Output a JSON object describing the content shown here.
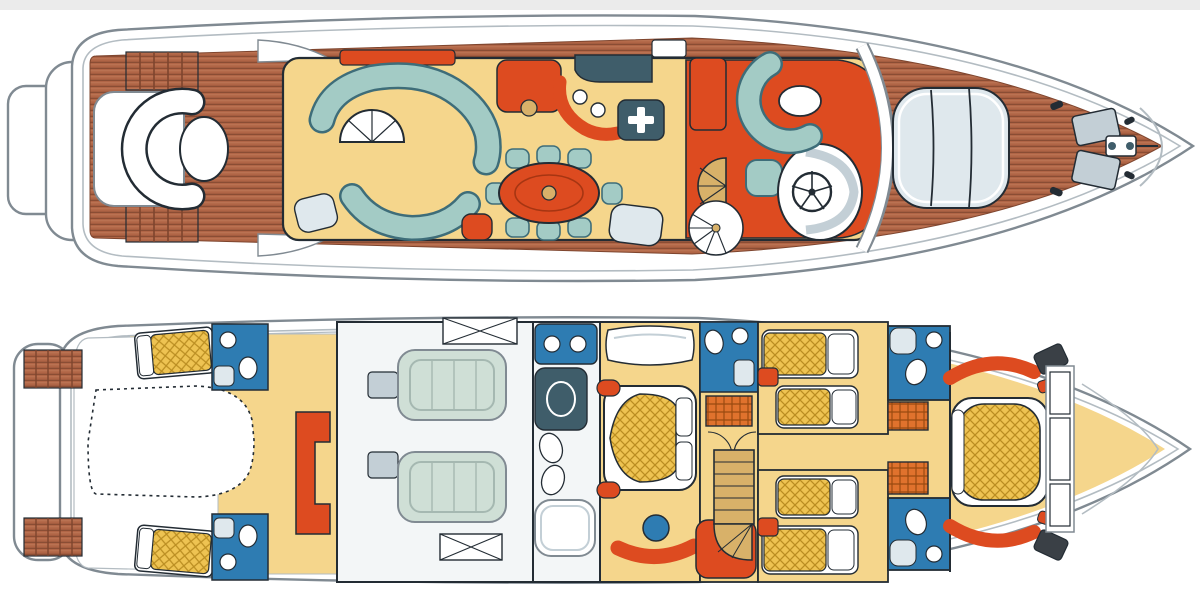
{
  "image": {
    "kind": "yacht deck plan illustration, top-down view",
    "decks_shown": 2,
    "background": "#ffffff"
  },
  "colors": {
    "page_top_band": "#ebebeb",
    "hull_stroke": "#808a92",
    "hull_fill": "#ffffff",
    "inner_line": "#b3bcc2",
    "outline": "#232c34",
    "teak": "#b06546",
    "teak_stripe": "#7e452e",
    "carpet_gold": "#f5d68c",
    "sofa_teal": "#a3cbc5",
    "sofa_edge": "#3e6d79",
    "accent_red": "#dd4b20",
    "slate": "#3f5d6a",
    "fixture_blue": "#2e7cb2",
    "pale_fixture": "#dfe8ed",
    "gray_fixture": "#c3cfd6",
    "engine_green": "#cfdfd6",
    "floor_white": "#f3f6f7",
    "mattress_gold": "#eec352",
    "mattress_line": "#bb8e22",
    "wardrobe_orange": "#e0722d",
    "wardrobe_line": "#9a4a10",
    "tan": "#d8b169"
  },
  "main_deck": {
    "label": "main deck plan",
    "areas": [
      "swim-platform",
      "transom-garage-door",
      "aft-deck-seating",
      "salon-lounge",
      "dining-area",
      "galley",
      "bar-counter",
      "spiral-staircase",
      "helm-station",
      "pilothouse-seating",
      "windshield",
      "foredeck-sunpad",
      "anchor-hatches",
      "side-decks"
    ]
  },
  "lower_deck": {
    "label": "lower deck plan",
    "areas": [
      "stern-platform",
      "tender-garage",
      "crew-cabin-port",
      "crew-cabin-starboard",
      "crew-bathrooms",
      "crew-mess",
      "engine-room",
      "master-bathroom",
      "master-cabin",
      "staircase-landing",
      "guest-cabin-port",
      "guest-cabin-starboard",
      "guest-bathrooms",
      "wardrobes",
      "vip-cabin",
      "bow-lockers"
    ]
  }
}
